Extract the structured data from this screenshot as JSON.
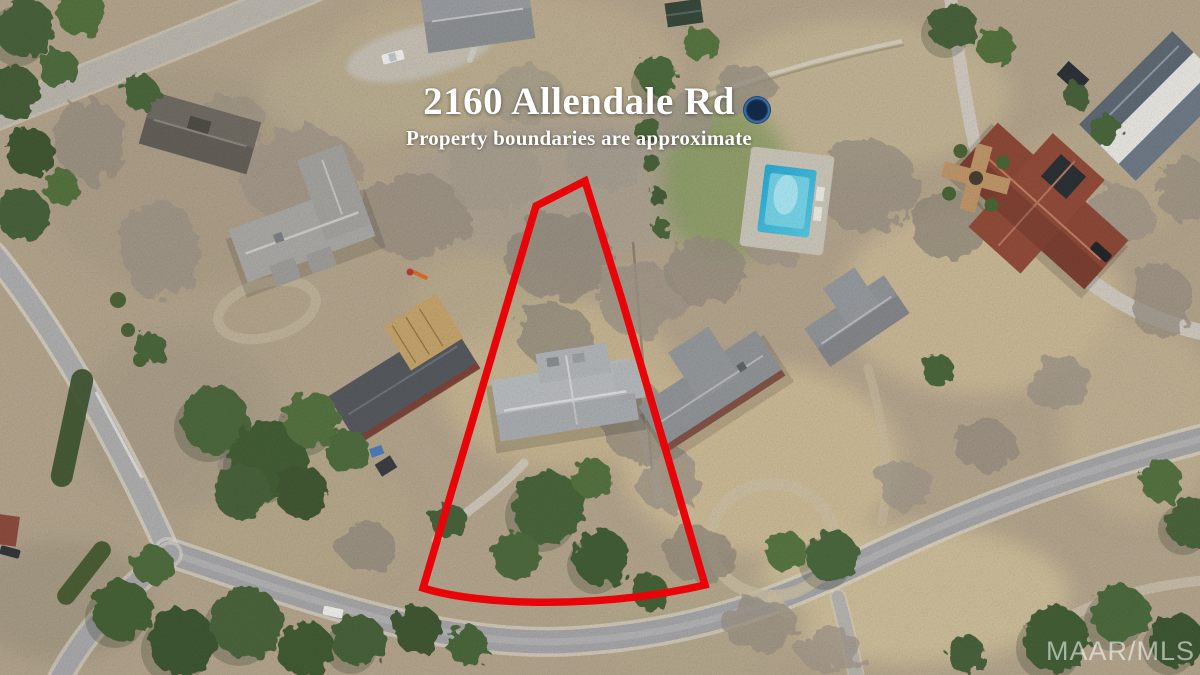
{
  "image": {
    "width": 1200,
    "height": 675,
    "kind": "aerial-drone-photo"
  },
  "overlay": {
    "address_title": "2160 Allendale Rd",
    "disclaimer": "Property boundaries are approximate",
    "watermark": "MAAR/MLS",
    "text_color": "#ffffff",
    "watermark_color": "rgba(255,255,255,0.55)"
  },
  "boundary": {
    "color": "#e80408",
    "stroke_width": 7.5,
    "shape": "wedge-shaped lot outline around subject property"
  },
  "scene": {
    "features": [
      "curving suburban street along bottom",
      "side street intersection at lower left",
      "subject lot outlined in red with gray-roof house",
      "neighboring gray-roof houses",
      "large red-tile-roof house upper right",
      "white house with slate roof top right corner",
      "swimming pool with deck",
      "trampoline",
      "bare winter trees and green pines",
      "dry tan lawns"
    ],
    "colors": {
      "ground": "#b0a18a",
      "dry_grass": "#c6b592",
      "road": "#a2a2a4",
      "green_tree": "#47603a",
      "bare_tree": "#988f82",
      "subject_roof": "#b5b8bb",
      "red_roof": "#8a4737",
      "pool_water": "#2aa6cd"
    }
  }
}
